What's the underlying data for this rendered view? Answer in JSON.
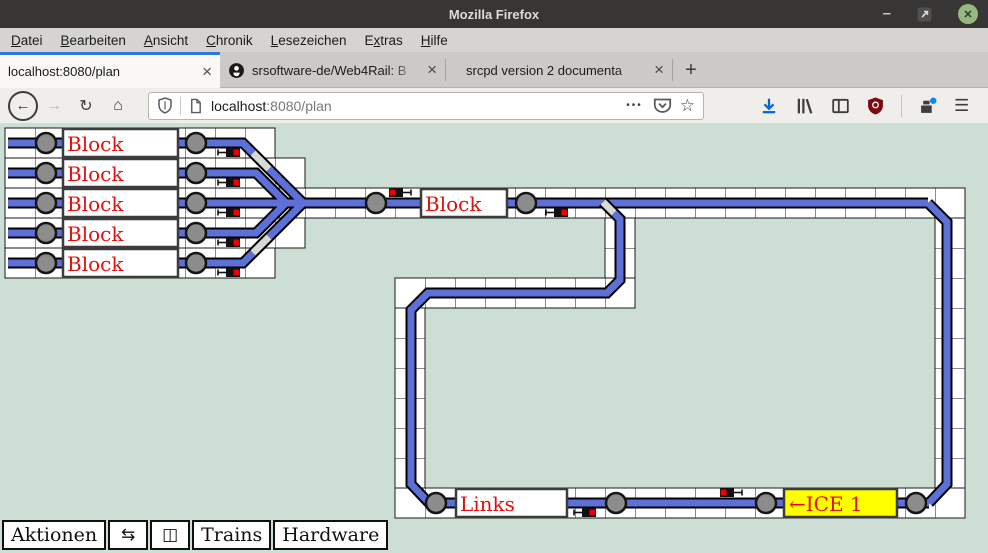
{
  "window": {
    "title": "Mozilla Firefox",
    "minimize_glyph": "–",
    "close_glyph": "✕"
  },
  "menubar": {
    "items": [
      {
        "pre": "",
        "key": "D",
        "post": "atei"
      },
      {
        "pre": "",
        "key": "B",
        "post": "earbeiten"
      },
      {
        "pre": "",
        "key": "A",
        "post": "nsicht"
      },
      {
        "pre": "",
        "key": "C",
        "post": "hronik"
      },
      {
        "pre": "",
        "key": "L",
        "post": "esezeichen"
      },
      {
        "pre": "E",
        "key": "x",
        "post": "tras"
      },
      {
        "pre": "",
        "key": "H",
        "post": "ilfe"
      }
    ]
  },
  "tabbar": {
    "tabs": [
      {
        "title": "localhost:8080/plan",
        "active": true,
        "close_glyph": "×"
      },
      {
        "title": "srsoftware-de/Web4Rail: B",
        "favicon": "github-icon",
        "active": false,
        "close_glyph": "×"
      },
      {
        "title": "srcpd version 2 documenta",
        "active": false,
        "close_glyph": "×"
      }
    ],
    "new_tab_glyph": "+"
  },
  "navbar": {
    "back_glyph": "←",
    "forward_glyph": "→",
    "reload_glyph": "↻",
    "home_glyph": "⌂",
    "url": {
      "host": "localhost",
      "path": ":8080/plan"
    },
    "page_actions_glyph": "•••",
    "bookmark_glyph": "☆",
    "menu_glyph": "☰",
    "icons": {
      "tracking_protection": "shield-icon",
      "page_info": "page-icon",
      "pocket": "pocket-icon",
      "download": "download-icon",
      "library": "library-icon",
      "sidebar": "sidebar-icon",
      "ublock": "ublock-shield-icon",
      "whats_new": "whats-new-icon"
    }
  },
  "plan": {
    "colors": {
      "background": "#cddfd5",
      "track": "#5d70d8",
      "inactive_track": "#d8d8d8",
      "contact": "#8c8c8c",
      "signal_red": "#ee0000",
      "block_text": "#e01010",
      "occupied_block": "#ffff00"
    },
    "blocks": [
      {
        "label": "Block"
      },
      {
        "label": "Block"
      },
      {
        "label": "Block"
      },
      {
        "label": "Block"
      },
      {
        "label": "Block"
      },
      {
        "label": "Block"
      },
      {
        "label": "Links"
      },
      {
        "label": "←ICE 1",
        "occupied_by": "ICE 1"
      }
    ]
  },
  "toolbar": {
    "buttons": [
      {
        "label": "Aktionen"
      },
      {
        "label": "⇆"
      },
      {
        "label": "◫"
      },
      {
        "label": "Trains"
      },
      {
        "label": "Hardware"
      }
    ]
  }
}
